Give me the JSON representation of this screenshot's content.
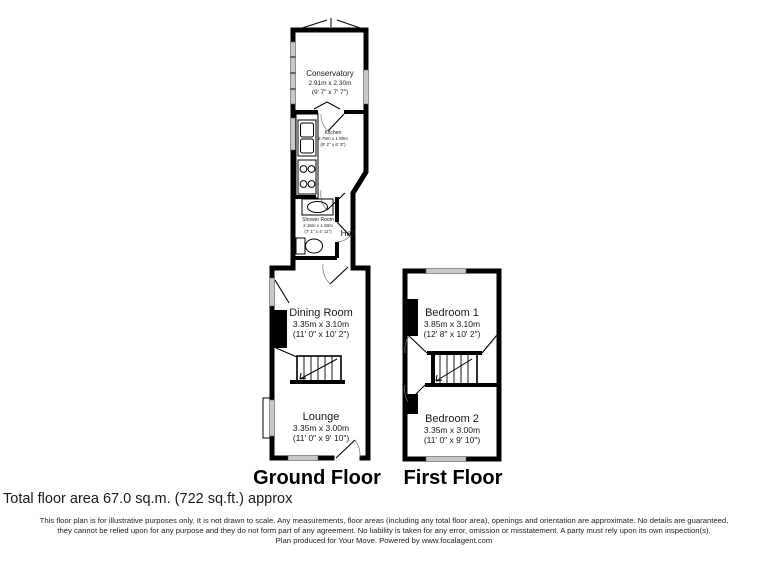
{
  "plans": {
    "ground": {
      "label": "Ground Floor",
      "rooms": {
        "conservatory": {
          "name": "Conservatory",
          "dims_m": "2.91m x 2.30m",
          "dims_ft": "(9' 7\" x 7' 7\")"
        },
        "kitchen": {
          "name": "Kitchen",
          "dims_m": "2.79m x 1.90m",
          "dims_ft": "(9' 2\" x 6' 3\")"
        },
        "shower_room": {
          "name": "Shower Room",
          "dims_m": "2.16m x 1.50m",
          "dims_ft": "(7' 1\" x 4' 11\")"
        },
        "hall": {
          "name": "Hall"
        },
        "dining_room": {
          "name": "Dining Room",
          "dims_m": "3.35m x 3.10m",
          "dims_ft": "(11' 0\" x 10' 2\")"
        },
        "lounge": {
          "name": "Lounge",
          "dims_m": "3.35m x 3.00m",
          "dims_ft": "(11' 0\" x 9' 10\")"
        }
      }
    },
    "first": {
      "label": "First Floor",
      "rooms": {
        "bedroom1": {
          "name": "Bedroom 1",
          "dims_m": "3.85m x 3.10m",
          "dims_ft": "(12' 8\" x 10' 2\")"
        },
        "bedroom2": {
          "name": "Bedroom 2",
          "dims_m": "3.35m x 3.00m",
          "dims_ft": "(11' 0\" x 9' 10\")"
        }
      }
    }
  },
  "footer": {
    "total_area": "Total floor area 67.0 sq.m. (722 sq.ft.) approx",
    "disclaimer_line1": "This floor plan is for illustrative purposes only. It is not drawn to scale. Any measurements, floor areas (including any total floor area), openings and orientation are approximate. No details are guaranteed,",
    "disclaimer_line2": "they cannot be relied upon for any purpose and they do not form part of any agreement. No liability is taken for any error, omission or misstatement. A party must rely upon its own inspection(s).",
    "disclaimer_line3": "Plan produced for Your Move. Powered by www.focalagent.com"
  },
  "colors": {
    "wall": "#000000",
    "window_glass": "#c8c8c8",
    "background": "#ffffff"
  }
}
